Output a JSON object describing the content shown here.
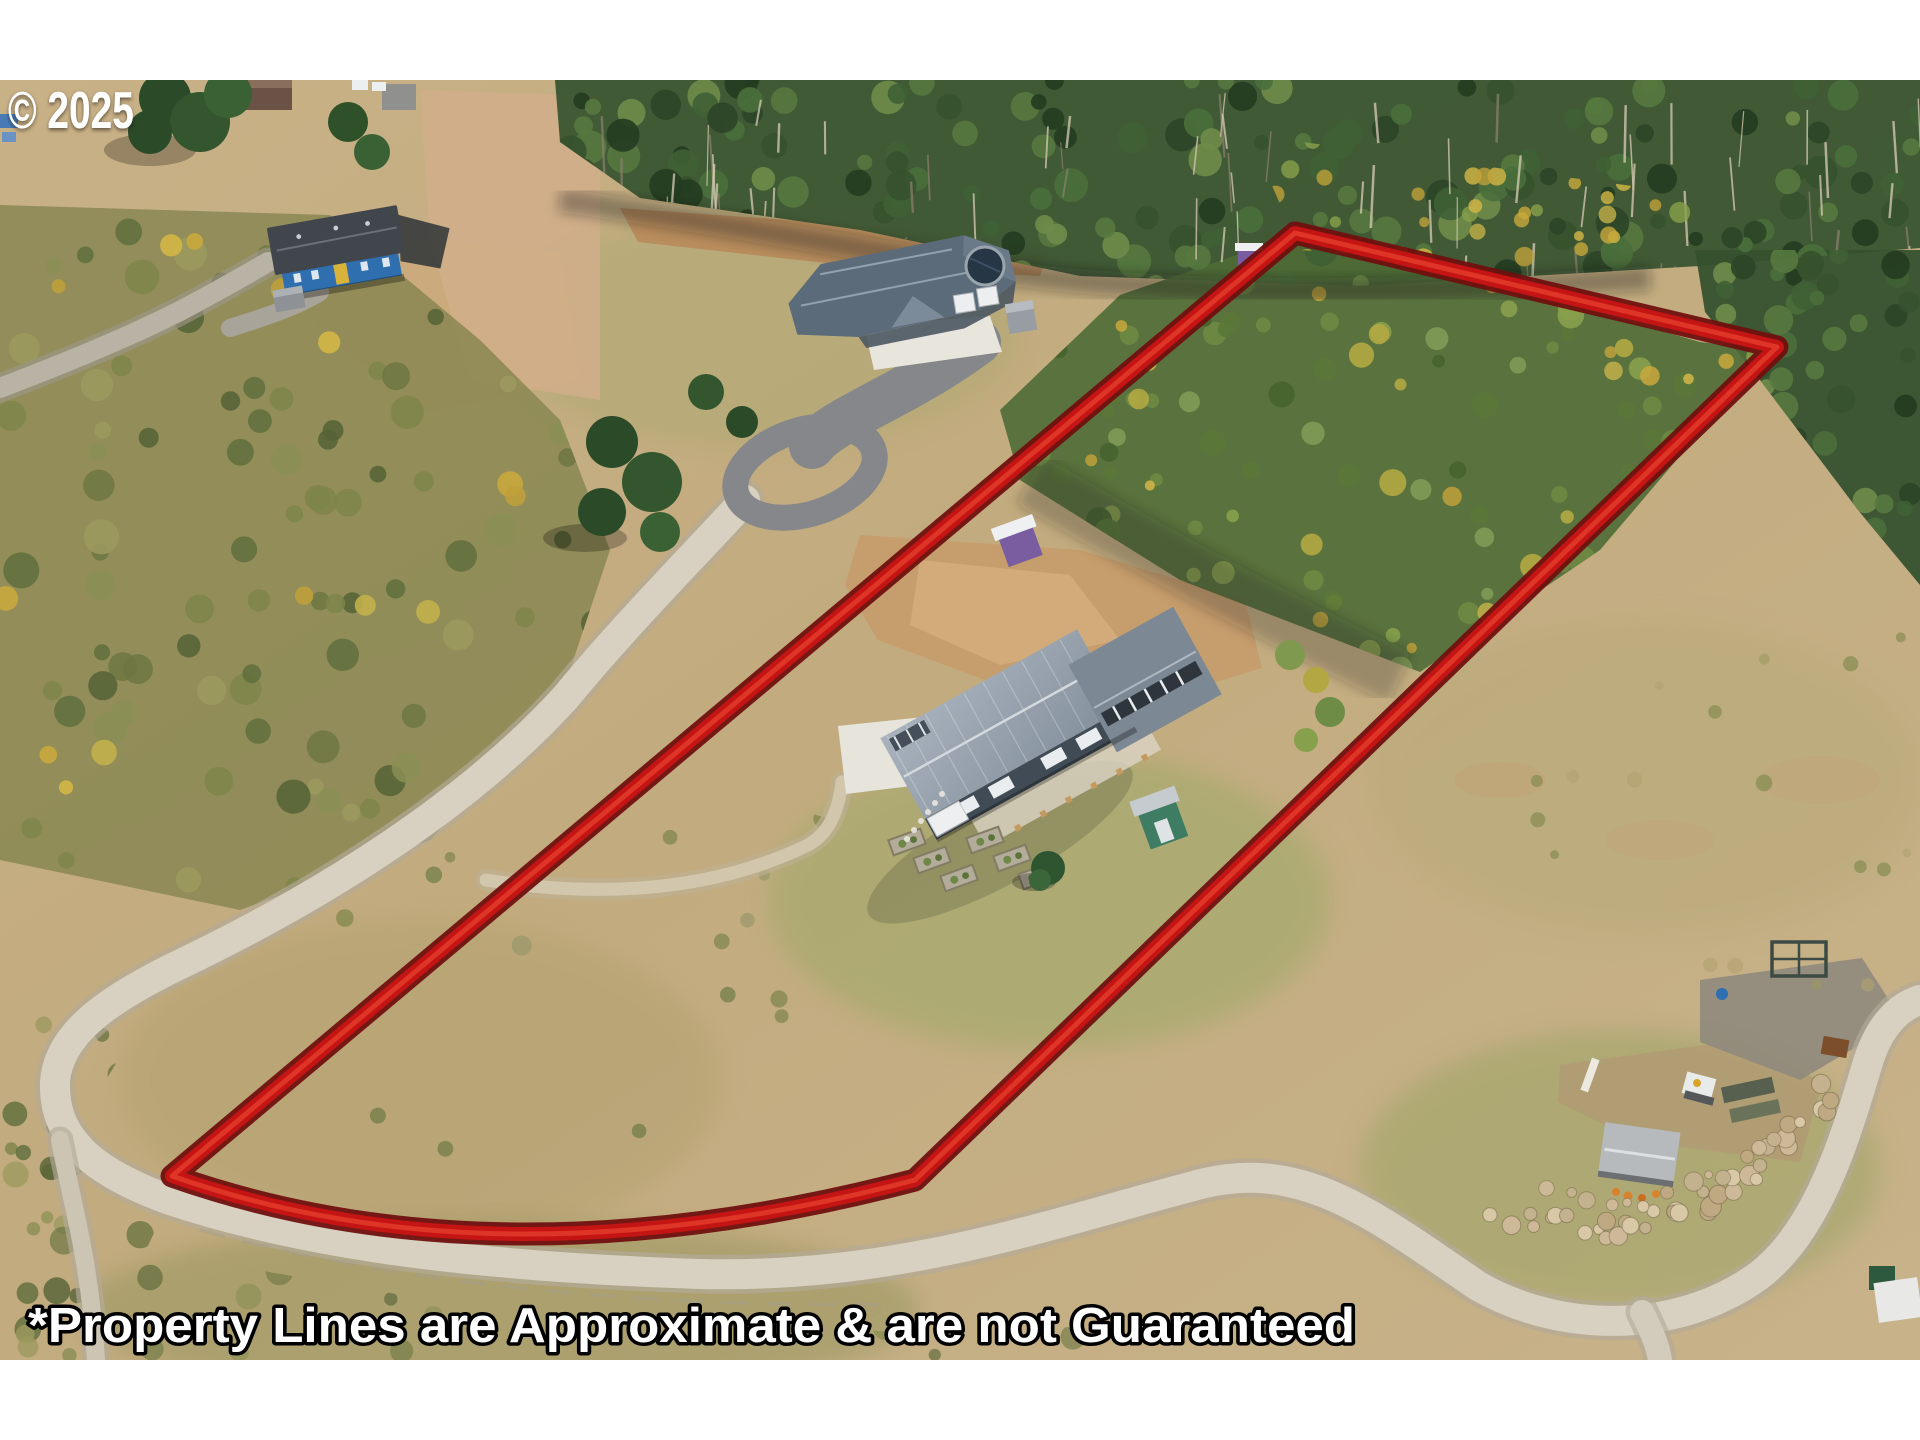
{
  "overlay": {
    "copyright": "© 2025",
    "disclaimer": "*Property Lines are Approximate & are not Guaranteed"
  },
  "palette": {
    "boundary_red": "#c41414",
    "boundary_dark": "#70100f",
    "boundary_highlight": "#e8402c",
    "letterbox_white": "#ffffff",
    "text_fill": "#ffffff",
    "text_outline": "#000000"
  },
  "scene": {
    "features": [
      {
        "name": "property-boundary-outline"
      },
      {
        "name": "subject-house-metal-roof"
      },
      {
        "name": "green-garden-shed"
      },
      {
        "name": "raised-garden-beds"
      },
      {
        "name": "purple-outbuilding"
      },
      {
        "name": "neighbor-house-gray-roof"
      },
      {
        "name": "neighbor-house-blue"
      },
      {
        "name": "trampoline"
      },
      {
        "name": "gravel-road"
      },
      {
        "name": "driveway-loop"
      },
      {
        "name": "storage-shed"
      },
      {
        "name": "rock-pile"
      },
      {
        "name": "forest"
      },
      {
        "name": "dry-grass-field"
      }
    ]
  }
}
